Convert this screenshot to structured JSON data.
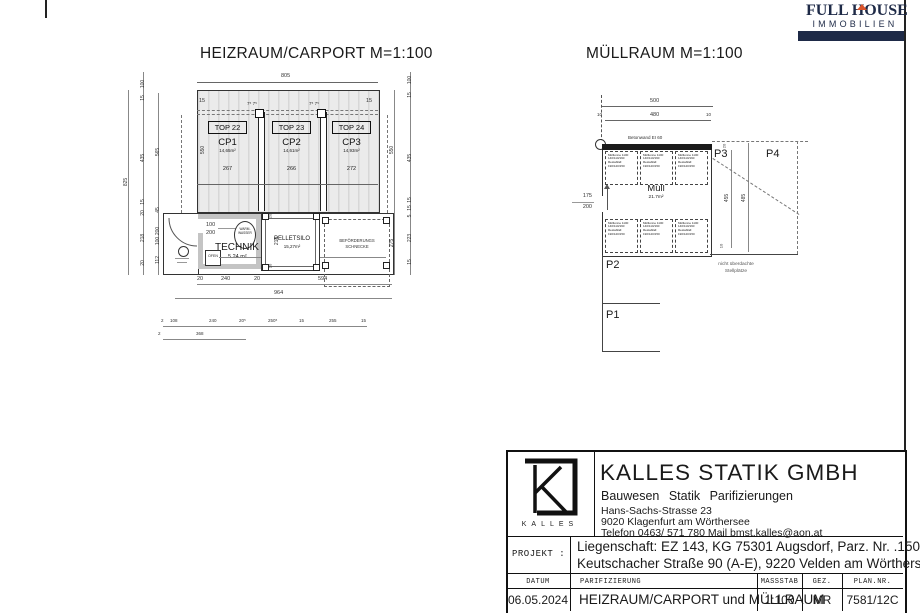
{
  "colors": {
    "navy": "#1e2a47",
    "orange": "#d9542b",
    "hatch": "#d7d7d7"
  },
  "logo": {
    "top": "FULL HOUSE",
    "bottom": "IMMOBILIEN"
  },
  "heizraum": {
    "title": "HEIZRAUM/CARPORT M=1:100",
    "dim_top": "805",
    "dim_15_left": "15",
    "dim_15_right": "15",
    "col_marks": "7⁵ 7⁵",
    "units": [
      {
        "top": "TOP 22",
        "cp": "CP1",
        "area": "14,65m²",
        "w": "267"
      },
      {
        "top": "TOP 23",
        "cp": "CP2",
        "area": "14,61m²",
        "w": "266"
      },
      {
        "top": "TOP 24",
        "cp": "CP3",
        "area": "14,93m²",
        "w": "272"
      }
    ],
    "dim_550_left": "550",
    "chain_total": "825",
    "chain_a": [
      "100",
      "15",
      "435",
      "15",
      "20",
      "218",
      "20"
    ],
    "chain_b": [
      "565",
      "45",
      "200",
      "100",
      "112"
    ],
    "chain_ri": [
      "550",
      "275"
    ],
    "chain_ro": [
      "100",
      "15",
      "435",
      "15",
      "15",
      "5",
      "223",
      "15"
    ],
    "technik": {
      "door1": "100",
      "door2": "200",
      "ww": "WARM-\nWASSER",
      "name": "TECHNIK",
      "area": "5.24 m²",
      "ofen": "OFEN"
    },
    "silo": {
      "name": "PELLETSILO",
      "area": "15,27m²",
      "h": "218",
      "w20a": "20",
      "w20b": "20"
    },
    "schnecke": "BEFÖRDERUNGS\nSCHNECKE",
    "b1": [
      "20",
      "240",
      "20",
      "594"
    ],
    "b_total": "964",
    "b2": [
      "2",
      "108",
      "240",
      "20⁵",
      "250⁵",
      "15",
      "255",
      "15"
    ],
    "b3": [
      "2",
      "368"
    ]
  },
  "muellraum": {
    "title": "MÜLLRAUM M=1:100",
    "d500": "500",
    "d480": "480",
    "d10l": "10",
    "d10r": "10",
    "wall": "Betonwand EI 60",
    "name": "Müll",
    "area": "21.7m²",
    "bin_text": "Mülltonne 1100\n140/110/190\nRestabfall\n190/120/150",
    "door1": "175",
    "door2": "200",
    "p1": "P1",
    "p2": "P2",
    "p3": "P3",
    "p4": "P4",
    "v20": "20",
    "v455": "455",
    "v485": "485",
    "v10": "10",
    "note": "nicht überdachte\nStellplätze"
  },
  "titleblock": {
    "brand": "KALLES",
    "company": "KALLES STATIK GMBH",
    "services": "Bauwesen   Statik   Parifizierungen",
    "address1": "Hans-Sachs-Strasse 23",
    "address2": "9020 Klagenfurt am Wörthersee",
    "address3": "Telefon 0463/ 571 780    Mail bmst.kalles@aon.at",
    "projekt_label": "PROJEKT :",
    "projekt1": "Liegenschaft: EZ 143, KG 75301 Augsdorf, Parz. Nr. .150, 594/2",
    "projekt2": "Keutschacher Straße 90 (A-E),  9220 Velden am Wörthersee",
    "h_datum": "DATUM",
    "h_parif": "PARIFIZIERUNG",
    "h_mass": "MASSSTAB",
    "h_gez": "GEZ.",
    "h_plan": "PLAN.NR.",
    "datum": "06.05.2024",
    "parif": "HEIZRAUM/CARPORT und MÜLLRAUM",
    "mass": "1:100",
    "gez": "MR",
    "plan": "7581/12C"
  }
}
